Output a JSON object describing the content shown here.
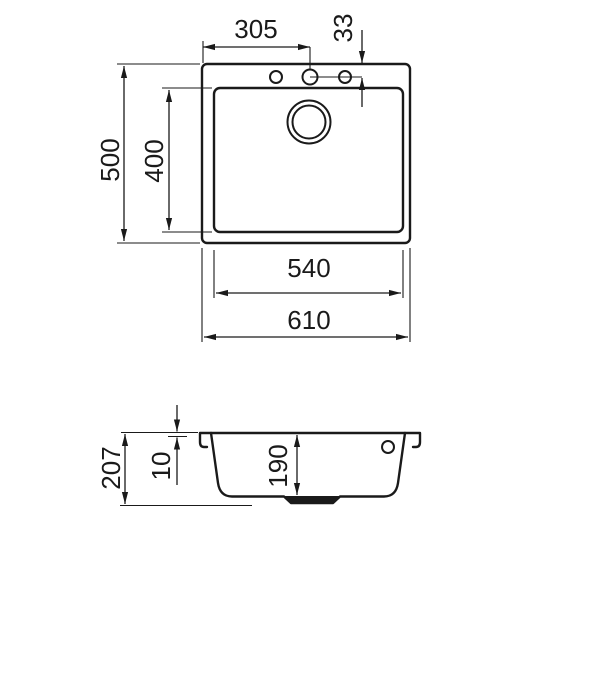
{
  "page": {
    "background": "#ffffff",
    "line_color": "#1a1a1a"
  },
  "views": {
    "top_view": {
      "labels": {
        "tap_hole_offset": "305",
        "tap_hole_edge_distance": "33",
        "overall_depth": "500",
        "bowl_depth": "400",
        "bowl_width": "540",
        "overall_width": "610"
      }
    },
    "section_view": {
      "labels": {
        "total_height": "207",
        "rim_thickness": "10",
        "bowl_inner_depth": "190"
      }
    }
  }
}
